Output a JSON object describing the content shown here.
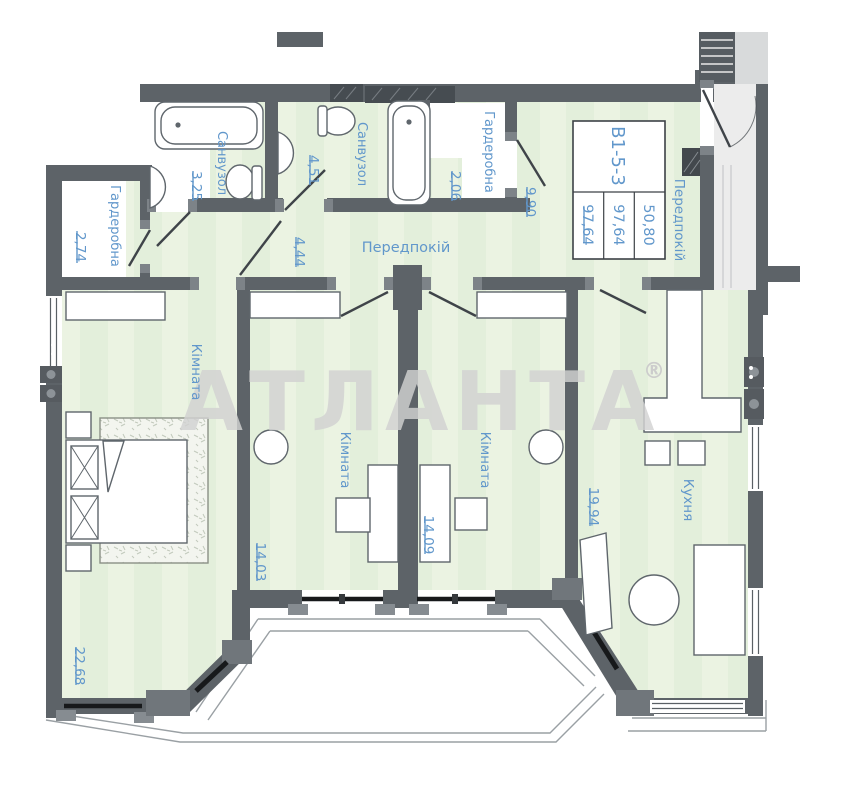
{
  "watermark": {
    "text": "АТЛАНТА",
    "registered": "®"
  },
  "stamp": {
    "unit": "В1-5-3",
    "total_area": "97,64",
    "reduced_area": "97,64",
    "living_area": "50,80"
  },
  "labels": {
    "wardrobe_left": {
      "name": "Гардеробна",
      "area": "2,74"
    },
    "bath_small": {
      "name": "Санвузол",
      "area": "3,25"
    },
    "bath_large": {
      "name": "Санвузол",
      "area": "4,51"
    },
    "wardrobe_top": {
      "name": "Гардеробна",
      "area": "2,06"
    },
    "hall": {
      "name": "Передпокій",
      "area": "9,90"
    },
    "corridor": {
      "area": "4,44"
    },
    "hall_right": {
      "name": "Передпокій"
    },
    "bedroom": {
      "name": "Кімната",
      "area": "22,68"
    },
    "room_mid_left": {
      "name": "Кімната",
      "area": "14,03"
    },
    "room_mid_right": {
      "name": "Кімната",
      "area": "14,09"
    },
    "kitchen": {
      "name": "Кухня",
      "area": "19,94"
    }
  },
  "colors": {
    "wall": "#5d6368",
    "floor": "#e3efdb",
    "label_blue": "#6197cb",
    "watermark_gray": "#d2d2d2"
  }
}
